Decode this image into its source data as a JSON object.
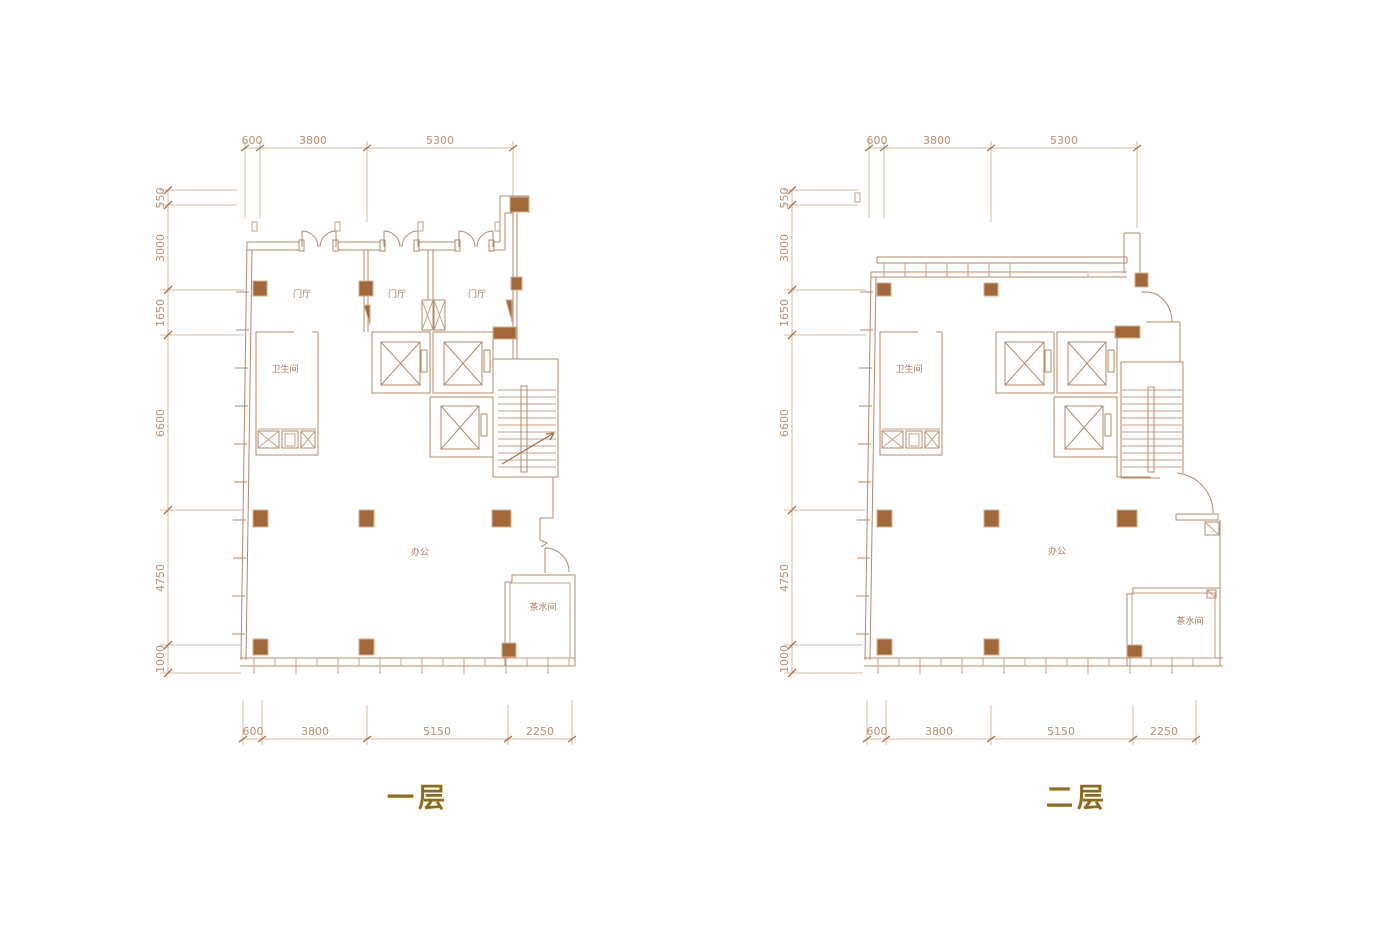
{
  "colors": {
    "wall": "#b4886a",
    "wall2": "#c9a284",
    "dim": "#d5b99c",
    "tickc": "#a5714a",
    "column": "#a2683a",
    "colborder": "#d2b28d",
    "dimtext": "#bb8f6e",
    "roomtext": "#a9795a",
    "title": "#8c6d15",
    "bg": "#ffffff"
  },
  "floor1": {
    "title": "一层",
    "top_dims": [
      "600",
      "3800",
      "5300"
    ],
    "left_dims": [
      "550",
      "3000",
      "1650",
      "6600",
      "4750",
      "1000"
    ],
    "bottom_dims": [
      "600",
      "3800",
      "5150",
      "2250"
    ],
    "rooms": {
      "foyer1": "门厅",
      "foyer2": "门厅",
      "foyer3": "门厅",
      "bathroom": "卫生间",
      "office": "办公",
      "pantry": "茶水间"
    }
  },
  "floor2": {
    "title": "二层",
    "top_dims": [
      "600",
      "3800",
      "5300"
    ],
    "left_dims": [
      "550",
      "3000",
      "1650",
      "6600",
      "4750",
      "1000"
    ],
    "bottom_dims": [
      "600",
      "3800",
      "5150",
      "2250"
    ],
    "rooms": {
      "bathroom": "卫生间",
      "office": "办公",
      "pantry": "茶水间"
    }
  }
}
